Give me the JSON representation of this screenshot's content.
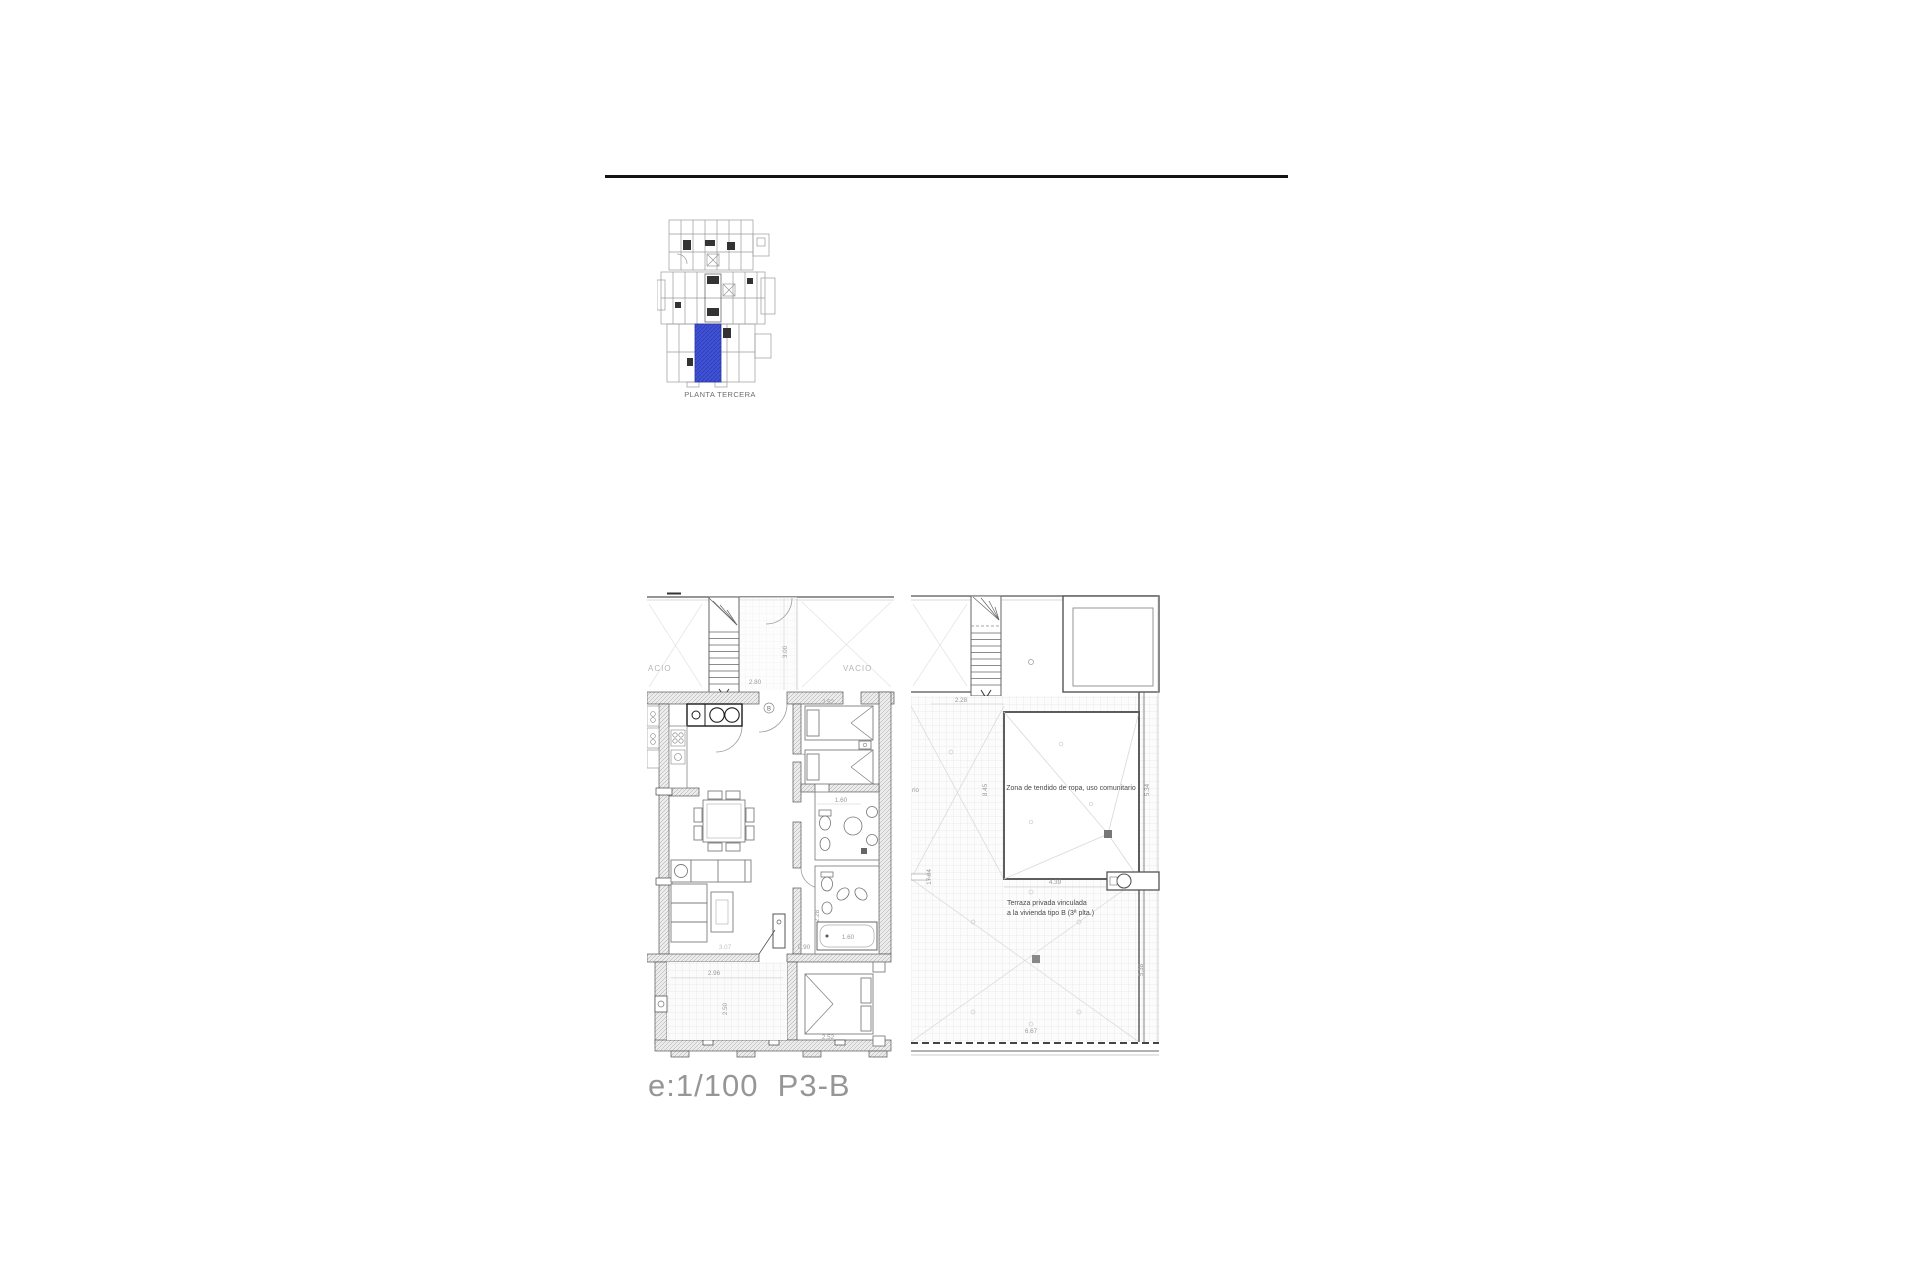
{
  "page": {
    "scale_label": "e:1/100  P3-B"
  },
  "key_plan": {
    "caption": "PLANTA TERCERA",
    "highlight_color": "#3d4fd0"
  },
  "apartment_plan": {
    "void_label_left": "ACIO",
    "void_label_right": "VACIO",
    "door_label": "B",
    "dims": {
      "stair_depth": "3.00",
      "stair_width": "2.80",
      "bedroom1_width": "2.52",
      "bath_upper_width": "1.60",
      "hall_depth": "2.28",
      "bath_lower_width": "0.90",
      "tub_length": "1.60",
      "living_width": "3.07",
      "terrace_width": "2.96",
      "terrace_depth": "2.50",
      "bedroom2_width": "2.52"
    }
  },
  "terrace_plan": {
    "laundry_label": "Zona de tendido de ropa, uso comunitario",
    "terrace_label_line1": "Terraza privada vinculada",
    "terrace_label_line2": "a la vivienda tipo B (3ª plta.)",
    "clipped_label_fragment": "rio",
    "dims": {
      "strip_width": "2.28",
      "laundry_depth": "8.45",
      "laundry_right_depth": "5.34",
      "strip_depth": "17.04",
      "terrace_width_top": "4.39",
      "terrace_width_bottom": "6.67",
      "terrace_right_depth": "5.38"
    }
  }
}
